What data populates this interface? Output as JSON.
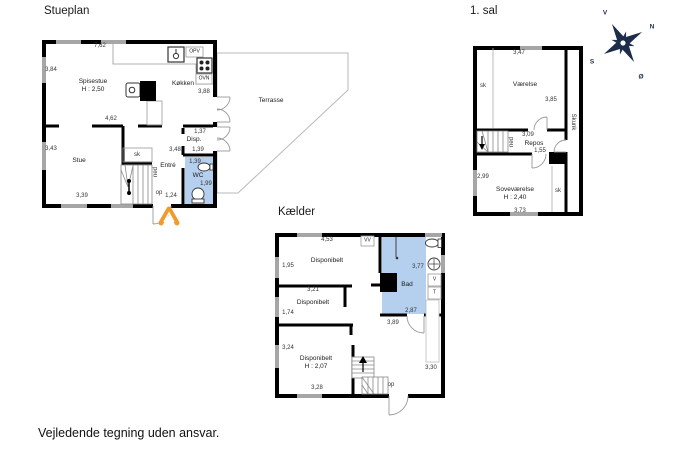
{
  "page": {
    "footer": "Vejledende tegning uden ansvar."
  },
  "compass": {
    "n": "N",
    "s": "S",
    "e": "Ø",
    "v": "V"
  },
  "stueplan": {
    "title": "Stueplan",
    "rooms": {
      "spisestue": "Spisestue",
      "spisestue_h": "H : 2,50",
      "koekken": "Køkken",
      "stue": "Stue",
      "entre": "Entré",
      "disp": "Disp.",
      "wc": "WC",
      "sk": "sk",
      "terrasse": "Terrasse"
    },
    "appliances": {
      "opv": "OPV",
      "ovn": "OVN"
    },
    "stairs": {
      "ned": "ned",
      "op": "op"
    },
    "dims": {
      "d762": "7,62",
      "d384": "3,84",
      "d388": "3,88",
      "d462": "4,62",
      "d343": "3,43",
      "d339": "3,39",
      "d348": "3,48",
      "d139_disp": "1,39",
      "d137": "1,37",
      "d139_wc": "1,39",
      "d199": "1,99",
      "d124": "1,24"
    }
  },
  "sal1": {
    "title": "1. sal",
    "rooms": {
      "vaerelse": "Værelse",
      "repos": "Repos",
      "sovevaerelse": "Soveværelse",
      "sovevaerelse_h": "H : 2,40",
      "skunk": "Skunk",
      "sk_left": "sk",
      "sk_right": "sk"
    },
    "stairs": {
      "ned": "ned"
    },
    "dims": {
      "d347": "3,47",
      "d385": "3,85",
      "d309": "3,09",
      "d155": "1,55",
      "d299": "2,99",
      "d373": "3,73"
    }
  },
  "kaelder": {
    "title": "Kælder",
    "rooms": {
      "disp1": "Disponibelt",
      "disp2": "Disponibelt",
      "disp3": "Disponibelt",
      "disp3_h": "H : 2,07",
      "bad": "Bad"
    },
    "appliances": {
      "vv": "VV",
      "v": "V",
      "t": "T"
    },
    "stairs": {
      "op": "op"
    },
    "dims": {
      "d453": "4,53",
      "d195": "1,95",
      "d321": "3,21",
      "d174": "1,74",
      "d377": "3,77",
      "d287": "2,87",
      "d389": "3,89",
      "d324": "3,24",
      "d328": "3,28",
      "d330": "3,30"
    }
  }
}
